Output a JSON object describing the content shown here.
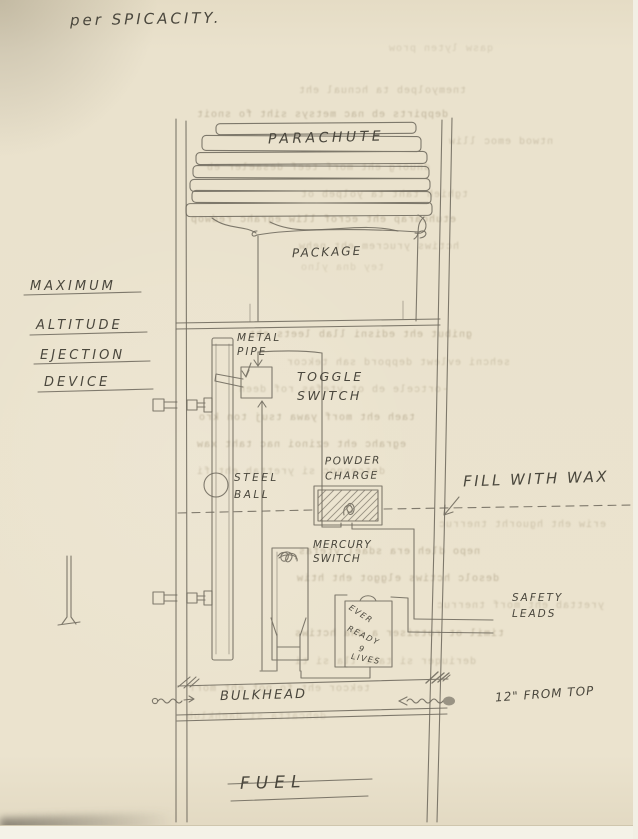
{
  "page": {
    "title": "per SPICACITY.",
    "paper_color": "#e9e1cc",
    "pencil_color": "#6f6a5e",
    "bleed_color": "#9d8f72"
  },
  "side_label": {
    "line1": "MAXIMUM",
    "line2": "ALTITUDE",
    "line3": "EJECTION",
    "line4": "DEVICE"
  },
  "labels": {
    "parachute": "PARACHUTE",
    "package": "PACKAGE",
    "metal_pipe_1": "METAL",
    "metal_pipe_2": "PIPE",
    "toggle_1": "TOGGLE",
    "toggle_2": "SWITCH",
    "steel_1": "STEEL",
    "steel_2": "BALL",
    "powder_1": "POWDER",
    "powder_2": "CHARGE",
    "fill_with_wax": "FILL WITH WAX",
    "mercury_1": "MERCURY",
    "mercury_2": "SWITCH",
    "battery_1": "EVER",
    "battery_2": "READY",
    "battery_3": "9",
    "battery_4": "LIVES",
    "safety_1": "SAFETY",
    "safety_2": "LEADS",
    "bulkhead": "BULKHEAD",
    "distance_note": "12\" FROM TOP",
    "fuel": "FUEL"
  },
  "bleedthrough": {
    "lines": [
      "qasw lyten prow",
      "tnemyolpeb ta hcnual eht",
      "deppirts eb nac metsys siht fo snoit",
      "ntwod emoc lliw",
      "dnuorg eht morf teef desaeler eb",
      "tghieh taht ta yolpeb ot",
      "etuhcarap eht ecrof lliw egrahc redwop",
      "hctiws yrucrem eht nehw",
      "tey dna ylno",
      "gnibut eht edisni llab leets eht",
      "sehcni evlewt deppord sah tekcor",
      "-ortcele eb ot ytefas rof deen",
      "taeh eht morf yawa tsuj ton kro",
      "egrahc eht ezinoi nac taht xaw",
      "detcennoc si yrettab eht fi",
      "eriw eht hguorht tnerruc",
      "nepo dleh era sdael ytefas",
      "desolc hctiws elggot eht htiw",
      "yrettab eht morf tnerruc",
      "timil ot rotsiser a dna hctiws",
      "deriuqer si taht lla si ti",
      "tekcor eht fo pot eht morf",
      "dehcatta si daehklub"
    ]
  }
}
